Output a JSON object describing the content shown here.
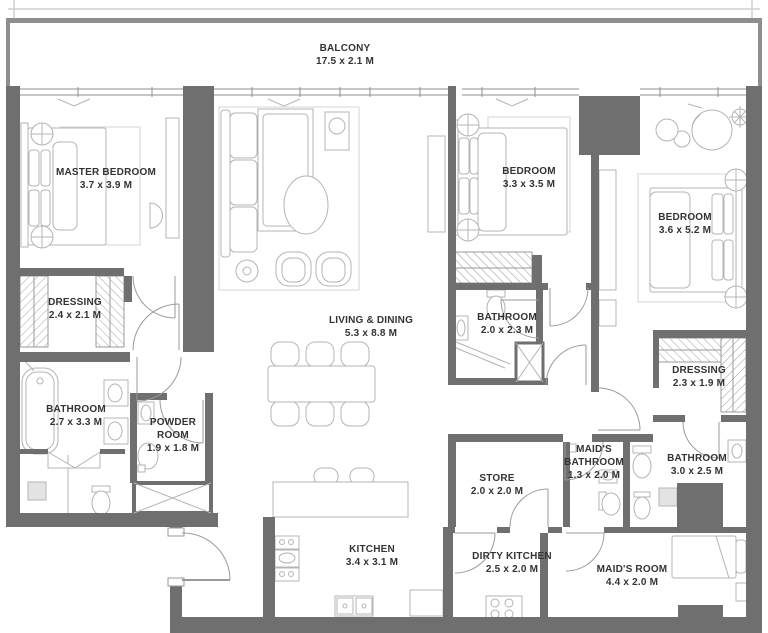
{
  "meta": {
    "drawing_type": "apartment floor plan",
    "units": "M"
  },
  "colors": {
    "wall": "#6F6F6F",
    "balcony_wall": "#8E8E8E",
    "window_line": "#8F8F8F",
    "furniture_line": "#B4B4B4",
    "rug_line": "#D5D5D5",
    "text": "#333333",
    "background": "#FFFFFF"
  },
  "rooms": {
    "balcony": {
      "name": "BALCONY",
      "dims": "17.5 x 2.1 M"
    },
    "master_bedroom": {
      "name": "MASTER BEDROOM",
      "dims": "3.7 x 3.9 M"
    },
    "dressing_master": {
      "name": "DRESSING",
      "dims": "2.4 x 2.1 M"
    },
    "bathroom_master": {
      "name": "BATHROOM",
      "dims": "2.7 x 3.3 M"
    },
    "powder_room": {
      "name": "POWDER ROOM",
      "dims": "1.9 x 1.8 M"
    },
    "living_dining": {
      "name": "LIVING & DINING",
      "dims": "5.3 x 8.8 M"
    },
    "kitchen": {
      "name": "KITCHEN",
      "dims": "3.4 x 3.1 M"
    },
    "bedroom_2": {
      "name": "BEDROOM",
      "dims": "3.3 x 3.5 M"
    },
    "bathroom_2": {
      "name": "BATHROOM",
      "dims": "2.0 x 2.3 M"
    },
    "bedroom_3": {
      "name": "BEDROOM",
      "dims": "3.6 x 5.2 M"
    },
    "dressing_2": {
      "name": "DRESSING",
      "dims": "2.3 x 1.9 M"
    },
    "bathroom_3": {
      "name": "BATHROOM",
      "dims": "3.0 x 2.5 M"
    },
    "maids_bathroom": {
      "name": "MAID'S BATHROOM",
      "dims": "1.3 x 2.0 M"
    },
    "store": {
      "name": "STORE",
      "dims": "2.0 x 2.0 M"
    },
    "dirty_kitchen": {
      "name": "DIRTY KITCHEN",
      "dims": "2.5 x 2.0 M"
    },
    "maids_room": {
      "name": "MAID'S ROOM",
      "dims": "4.4 x 2.0 M"
    }
  }
}
